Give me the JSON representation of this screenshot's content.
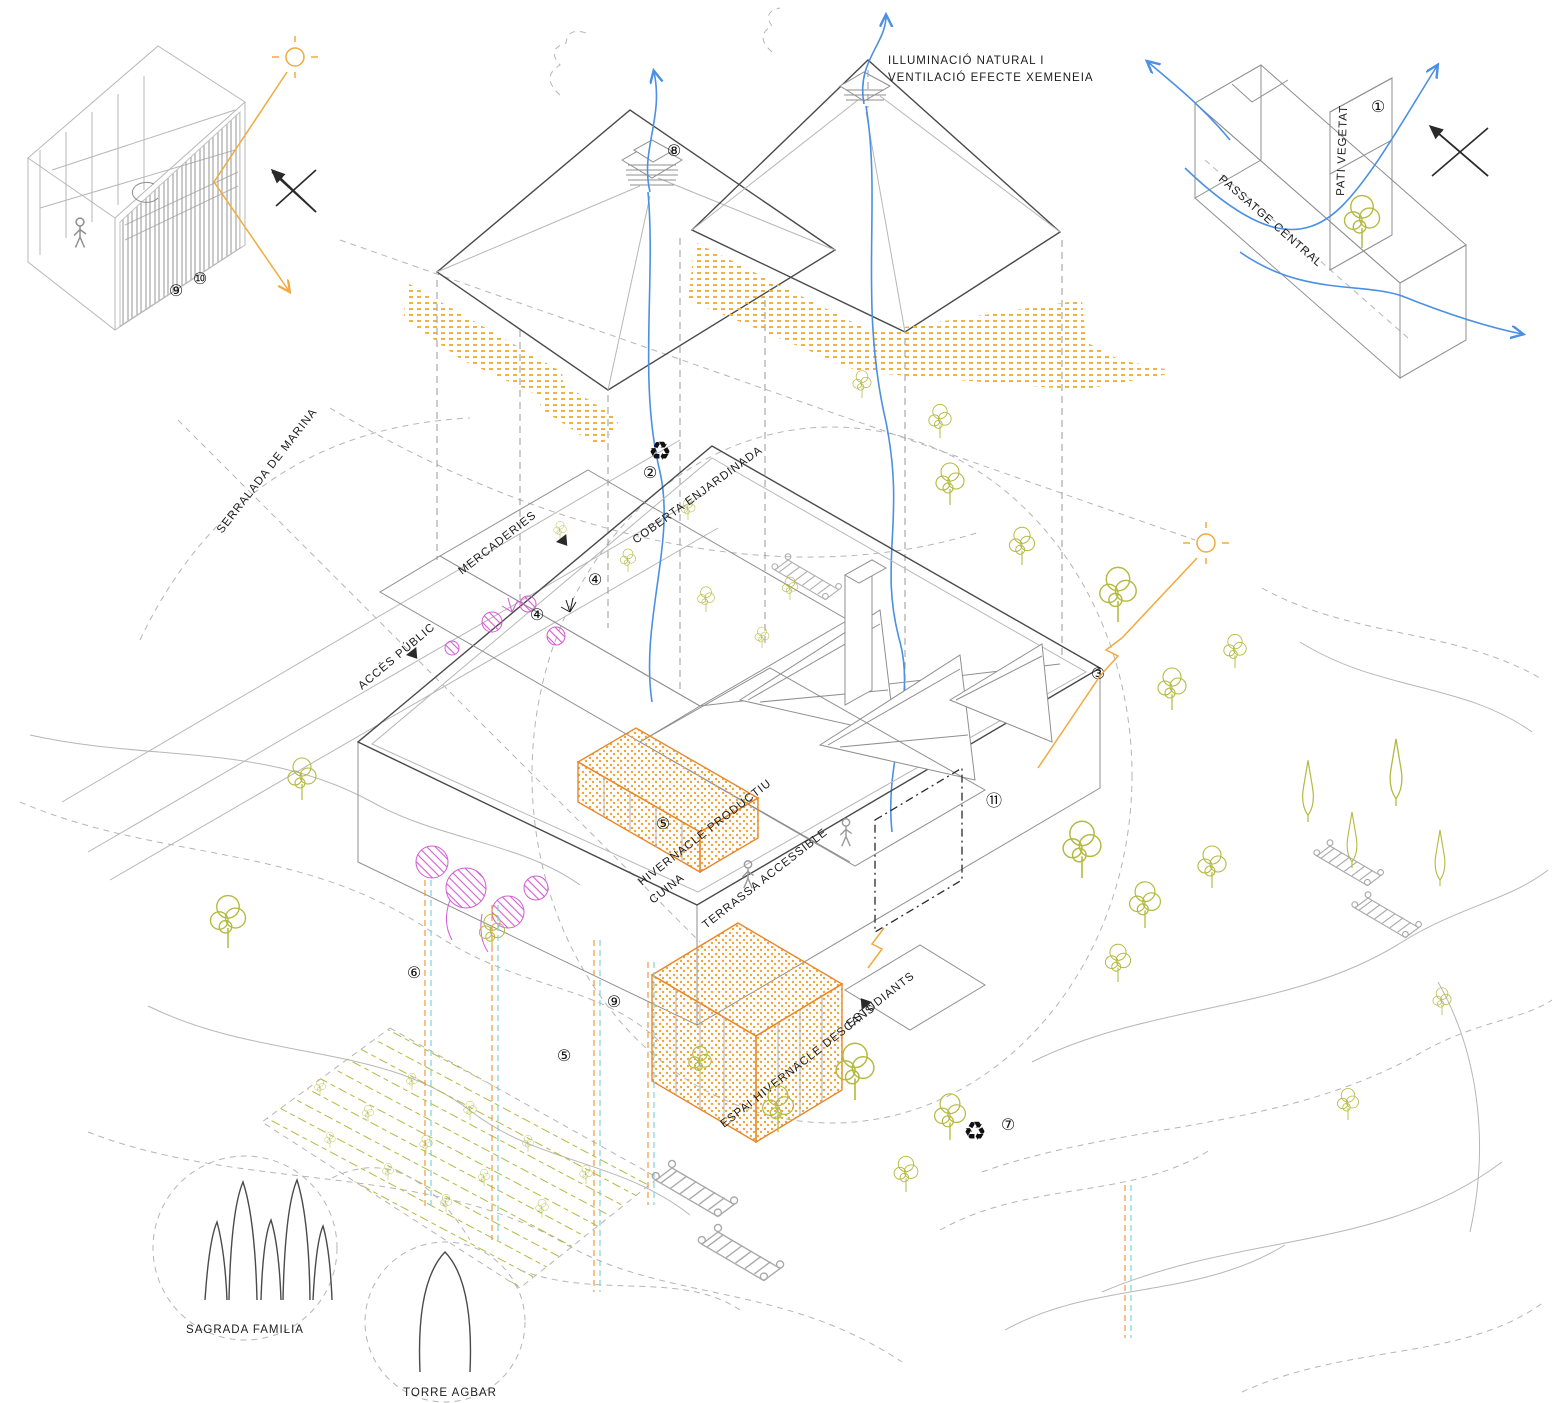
{
  "diagram": {
    "title": "exploded-axonometric-architecture-diagram",
    "annotations": {
      "illuminacio_line1": "ILLUMINACIÓ NATURAL I",
      "illuminacio_line2": "VENTILACIÓ EFECTE XEMENEIA",
      "passatge_central": "PASSATGE CENTRAL",
      "pati_vegetat": "PATI VEGETAT",
      "serralada": "SERRALADA DE MARINA",
      "mercaderies": "MERCADERIES",
      "acces_public": "ACCÈS PÚBLIC",
      "coberta_enjardinada": "COBERTA ENJARDINADA",
      "hivernacle_productiu": "HIVERNACLE PRODUCTIU",
      "cuina": "CUINA",
      "terrassa_accessible": "TERRASSA ACCESSIBLE",
      "estudiants": "ESTUDIANTS",
      "espai_hivernacle": "ESPAI HIVERNACLE DESCANS",
      "sagrada_familia": "SAGRADA FAMILIA",
      "torre_agbar": "TORRE AGBAR"
    },
    "callouts": {
      "one": "①",
      "two": "②",
      "three": "③",
      "four": "④",
      "five": "⑤",
      "six": "⑥",
      "seven": "⑦",
      "eight": "⑧",
      "nine": "⑨",
      "ten": "⑩",
      "eleven": "⑪"
    },
    "icons": {
      "recycle": "♻"
    },
    "colors": {
      "vegetation_olive": "#b4ba40",
      "sun_orange": "#f0ab3c",
      "yellow_dots": "#f0b43c",
      "greenhouse_orange": "#e8872a",
      "magenta_plants": "#d45cd4",
      "flow_blue": "#4b90e2",
      "hatch_blue": "#4379d8",
      "duct_cyan": "#7fd1dc",
      "linework_gray": "#8f8f8f",
      "ink": "#1c1c1c"
    }
  }
}
